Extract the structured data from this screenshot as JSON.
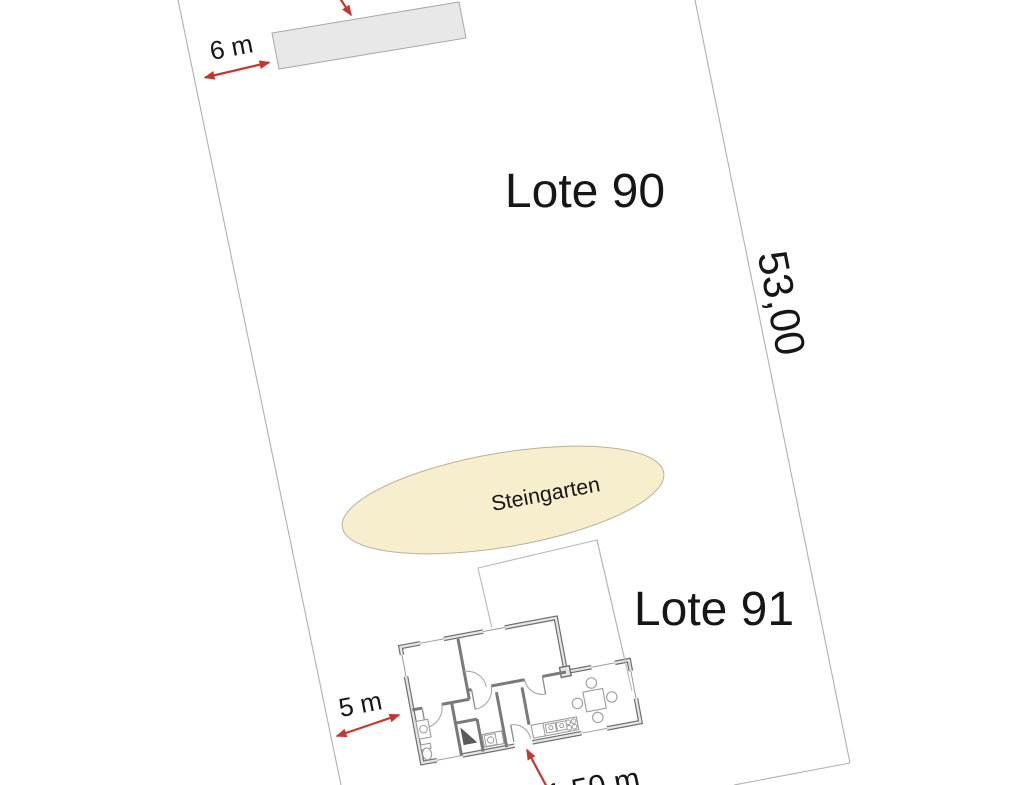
{
  "plan": {
    "lot_a_label": "Lote 90",
    "lot_b_label": "Lote 91",
    "garden_label": "Steingarten",
    "dim_top_setback": "6 m",
    "dim_side_length": "53,00",
    "dim_left_setback": "5 m",
    "dim_entry_width": "1,50 m"
  },
  "colors": {
    "dimension_red": "#c4372e",
    "boundary_gray": "#b0b0b0",
    "building_fill": "#e8e8e8",
    "garden_fill": "#f6eecd",
    "wall_dark": "#6e6e6e",
    "wall_light": "#e6e6e6",
    "text_black": "#161616",
    "background": "#ffffff"
  }
}
